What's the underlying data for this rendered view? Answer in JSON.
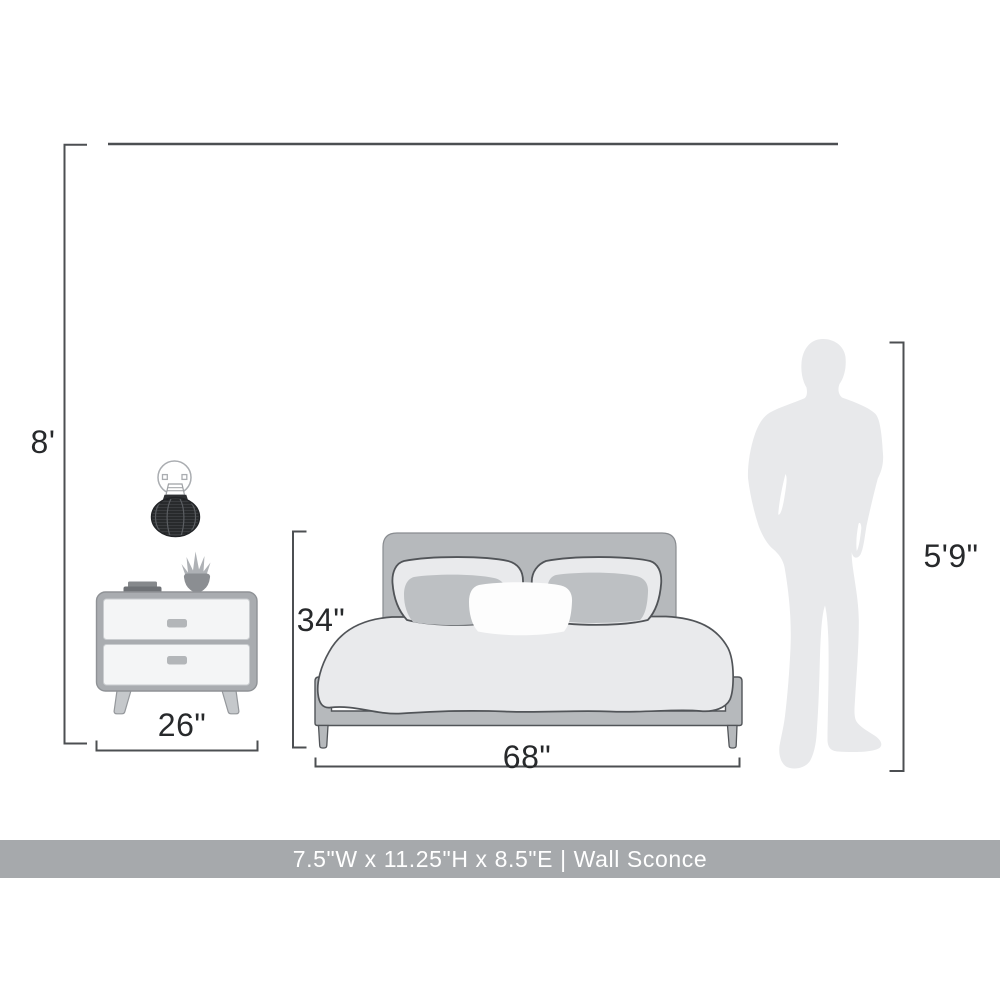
{
  "page": {
    "width_px": 1000,
    "height_px": 1000
  },
  "diagram": {
    "labels": {
      "wall_height": "8'",
      "nightstand_width": "26\"",
      "bed_height": "34\"",
      "bed_width": "68\"",
      "person_height": "5'9\""
    },
    "illustrations": [
      "wall-sconce-illustration",
      "nightstand-illustration",
      "bed-illustration",
      "person-silhouette"
    ]
  },
  "footer": {
    "text": "7.5\"W x 11.25\"H x 8.5\"E | Wall Sconce"
  },
  "colors": {
    "page_bg": "#ffffff",
    "line": "#4c4f52",
    "outline": "#515458",
    "label_text": "#27292b",
    "banner_bg": "#a6a9ac",
    "banner_text": "#ffffff",
    "silhouette": "#e8e9eb",
    "furniture_mid": "#b6b9bc",
    "furniture_light": "#e9eaec",
    "pillow_accent": "#bdc0c3",
    "pillow_white": "#fdfdfd",
    "nightstand_frame": "#a9acb0",
    "nightstand_panel": "#f4f5f6",
    "nightstand_handle": "#b3b6b9",
    "nightstand_leg": "#c5c8cb",
    "book_dark": "#6f7276",
    "book_light": "#86898c",
    "pot": "#8b8e92",
    "leaf": "#aeb1b5",
    "sconce_shade": "#3a3c3f",
    "sconce_shade_line": "#151719",
    "sconce_shade_rib": "#5b5e62",
    "sconce_outline": "#aaadb1"
  }
}
